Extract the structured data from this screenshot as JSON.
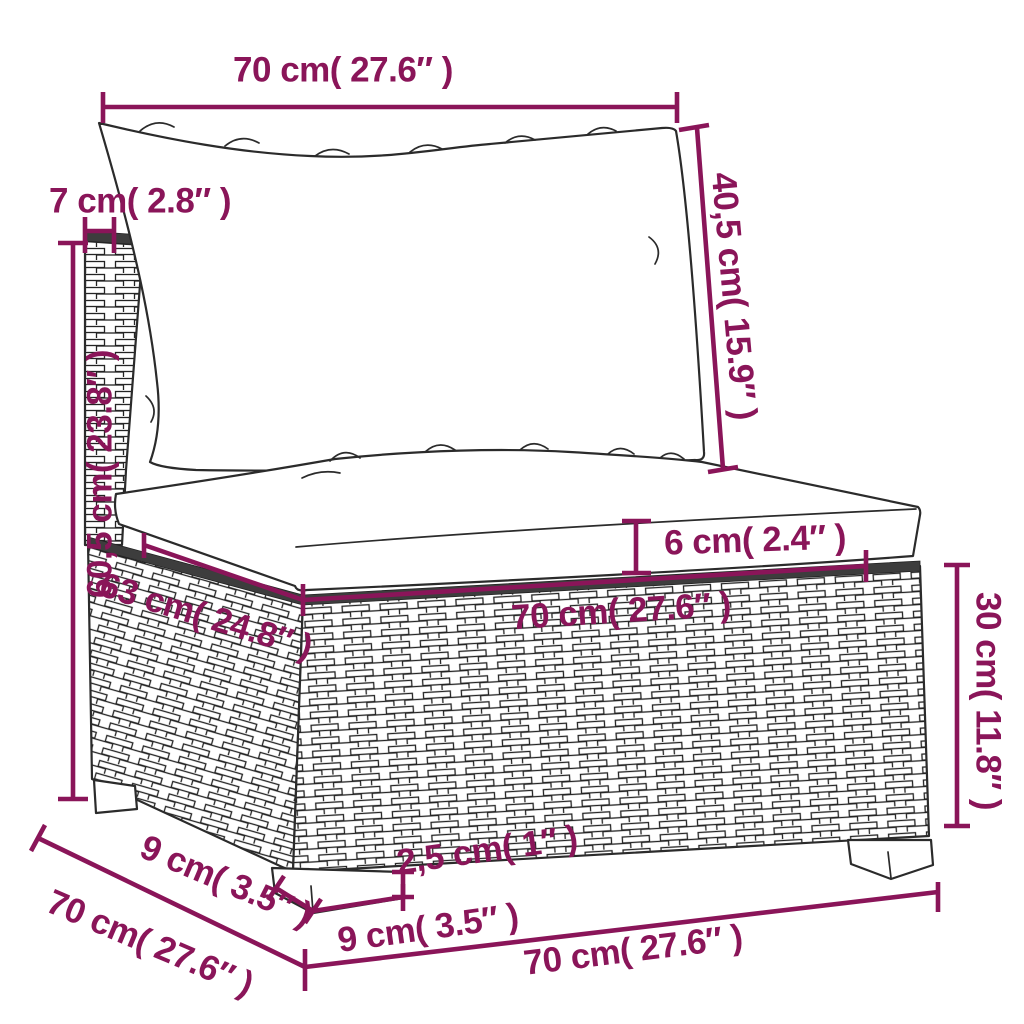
{
  "figure": {
    "type": "product-dimension-diagram",
    "subject": "poly-rattan garden sofa middle section with cushions",
    "accent_color": "#8a1559",
    "outline_color": "#2b2b2b",
    "background_color": "#ffffff"
  },
  "measurements": {
    "back_width": {
      "label": "70 cm( 27.6″  )"
    },
    "back_thickness": {
      "label": "7 cm( 2.8″  )"
    },
    "backrest_height": {
      "label": "40,5 cm( 15.9″ )"
    },
    "total_height": {
      "label": "60,5 cm( 23.8″  )"
    },
    "seat_cushion_thickness": {
      "label": "6 cm( 2.4″  )"
    },
    "seat_depth": {
      "label": "63 cm( 24.8″ )"
    },
    "seat_width": {
      "label": "70 cm( 27.6″ )"
    },
    "base_height": {
      "label": "30 cm( 11.8″ )"
    },
    "leg_depth": {
      "label": "9 cm( 3.5″ )"
    },
    "total_depth": {
      "label": "70 cm( 27.6″ )"
    },
    "leg_height": {
      "label": "2,5 cm( 1″ )"
    },
    "leg_width": {
      "label": "9 cm( 3.5″ )"
    },
    "front_width": {
      "label": "70 cm( 27.6″  )"
    }
  }
}
